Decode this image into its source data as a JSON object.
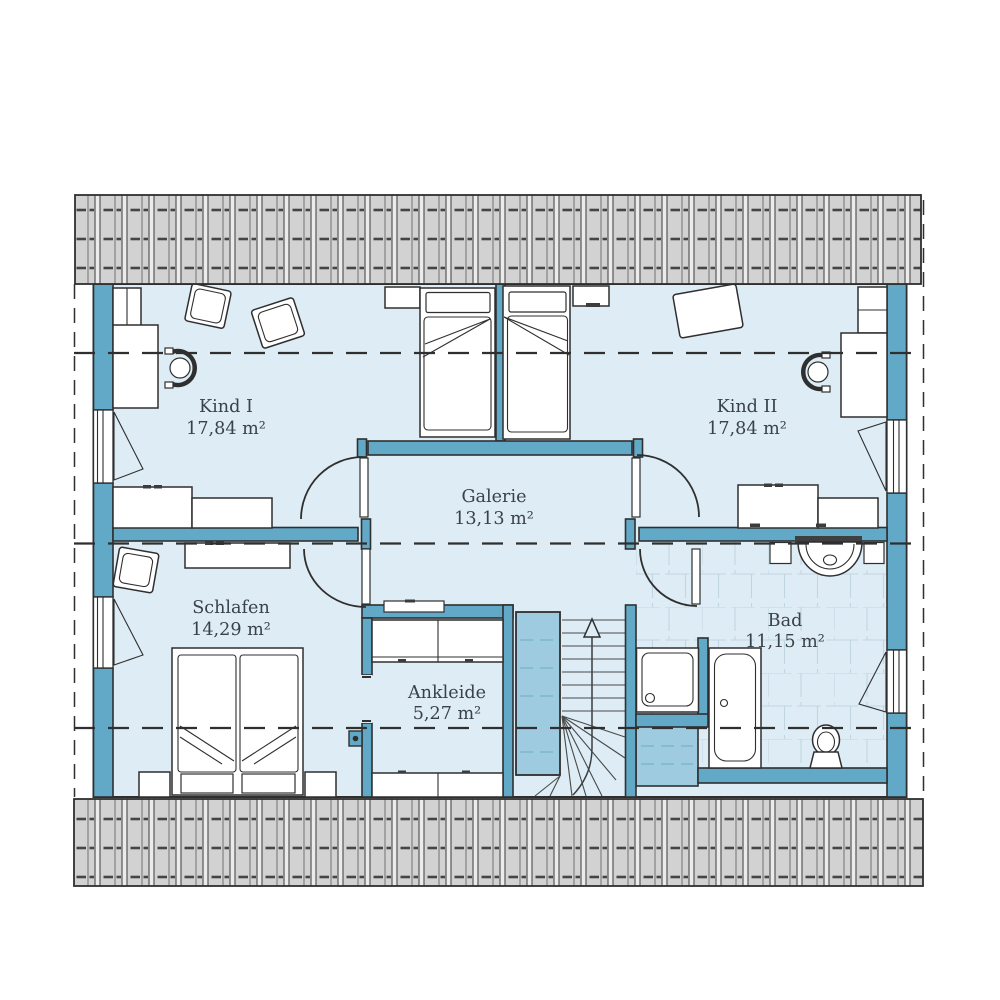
{
  "plan": {
    "rooms": [
      {
        "id": "kind1",
        "name": "Kind I",
        "area": "17,84 m²"
      },
      {
        "id": "kind2",
        "name": "Kind II",
        "area": "17,84 m²"
      },
      {
        "id": "galerie",
        "name": "Galerie",
        "area": "13,13 m²"
      },
      {
        "id": "schlafen",
        "name": "Schlafen",
        "area": "14,29 m²"
      },
      {
        "id": "ankleide",
        "name": "Ankleide",
        "area": "5,27 m²"
      },
      {
        "id": "bad",
        "name": "Bad",
        "area": "11,15 m²"
      }
    ],
    "colors": {
      "floor": "#ddecf5",
      "wall_teal": "#62a9c7",
      "void_blue": "#9ecbdf",
      "roof_gray": "#d2d2d2",
      "outline": "#2f2f2f",
      "tile_line": "#c2d6e1",
      "label_text": "#3a4249"
    }
  }
}
